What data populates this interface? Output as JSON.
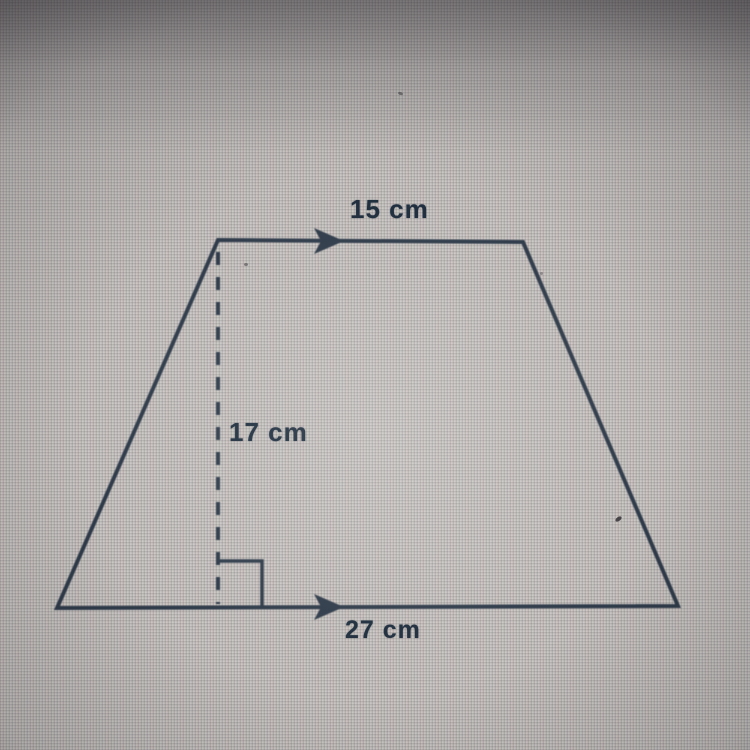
{
  "figure": {
    "type": "trapezoid",
    "description": "Trapezoid with parallel top and bottom sides marked by arrows, and a dashed vertical height with a right-angle marker",
    "labels": {
      "top_base": "15 cm",
      "height": "17 cm",
      "bottom_base": "27 cm"
    },
    "measurements": {
      "top_base_cm": 15,
      "height_cm": 17,
      "bottom_base_cm": 27,
      "unit": "cm"
    },
    "colors": {
      "line": "#2e3a49",
      "text": "#1d2c3c",
      "background": "#c7c3bf"
    }
  }
}
